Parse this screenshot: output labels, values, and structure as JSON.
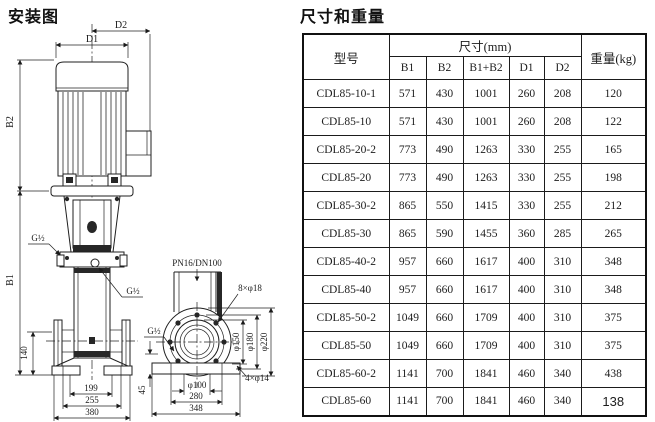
{
  "titles": {
    "left": "安装图",
    "right": "尺寸和重量"
  },
  "diagram": {
    "dims": {
      "d1": "D1",
      "d2": "D2",
      "b1": "B1",
      "b2": "B2",
      "h140": "140",
      "w199": "199",
      "w255": "255",
      "w380": "380",
      "h45": "45",
      "w280": "280",
      "w348": "348",
      "dia100": "φ100",
      "dia150": "φ150",
      "dia180": "φ180",
      "dia220": "φ220"
    },
    "labels": {
      "g_half": "G½",
      "flange_spec": "PN16/DN100",
      "flange_holes": "8×φ18",
      "base_holes": "4×φ14"
    }
  },
  "table": {
    "headers": {
      "model": "型号",
      "size": "尺寸(mm)",
      "weight": "重量(kg)",
      "size_cols": [
        "B1",
        "B2",
        "B1+B2",
        "D1",
        "D2"
      ]
    },
    "rows": [
      {
        "model": "CDL85-10-1",
        "b1": "571",
        "b2": "430",
        "b1b2": "1001",
        "d1": "260",
        "d2": "208",
        "w": "120"
      },
      {
        "model": "CDL85-10",
        "b1": "571",
        "b2": "430",
        "b1b2": "1001",
        "d1": "260",
        "d2": "208",
        "w": "122"
      },
      {
        "model": "CDL85-20-2",
        "b1": "773",
        "b2": "490",
        "b1b2": "1263",
        "d1": "330",
        "d2": "255",
        "w": "165"
      },
      {
        "model": "CDL85-20",
        "b1": "773",
        "b2": "490",
        "b1b2": "1263",
        "d1": "330",
        "d2": "255",
        "w": "198"
      },
      {
        "model": "CDL85-30-2",
        "b1": "865",
        "b2": "550",
        "b1b2": "1415",
        "d1": "330",
        "d2": "255",
        "w": "212"
      },
      {
        "model": "CDL85-30",
        "b1": "865",
        "b2": "590",
        "b1b2": "1455",
        "d1": "360",
        "d2": "285",
        "w": "265"
      },
      {
        "model": "CDL85-40-2",
        "b1": "957",
        "b2": "660",
        "b1b2": "1617",
        "d1": "400",
        "d2": "310",
        "w": "348"
      },
      {
        "model": "CDL85-40",
        "b1": "957",
        "b2": "660",
        "b1b2": "1617",
        "d1": "400",
        "d2": "310",
        "w": "348"
      },
      {
        "model": "CDL85-50-2",
        "b1": "1049",
        "b2": "660",
        "b1b2": "1709",
        "d1": "400",
        "d2": "310",
        "w": "375"
      },
      {
        "model": "CDL85-50",
        "b1": "1049",
        "b2": "660",
        "b1b2": "1709",
        "d1": "400",
        "d2": "310",
        "w": "375"
      },
      {
        "model": "CDL85-60-2",
        "b1": "1141",
        "b2": "700",
        "b1b2": "1841",
        "d1": "460",
        "d2": "340",
        "w": "438"
      },
      {
        "model": "CDL85-60",
        "b1": "1141",
        "b2": "700",
        "b1b2": "1841",
        "d1": "460",
        "d2": "340",
        "w": "138",
        "w_alt": true
      }
    ]
  }
}
